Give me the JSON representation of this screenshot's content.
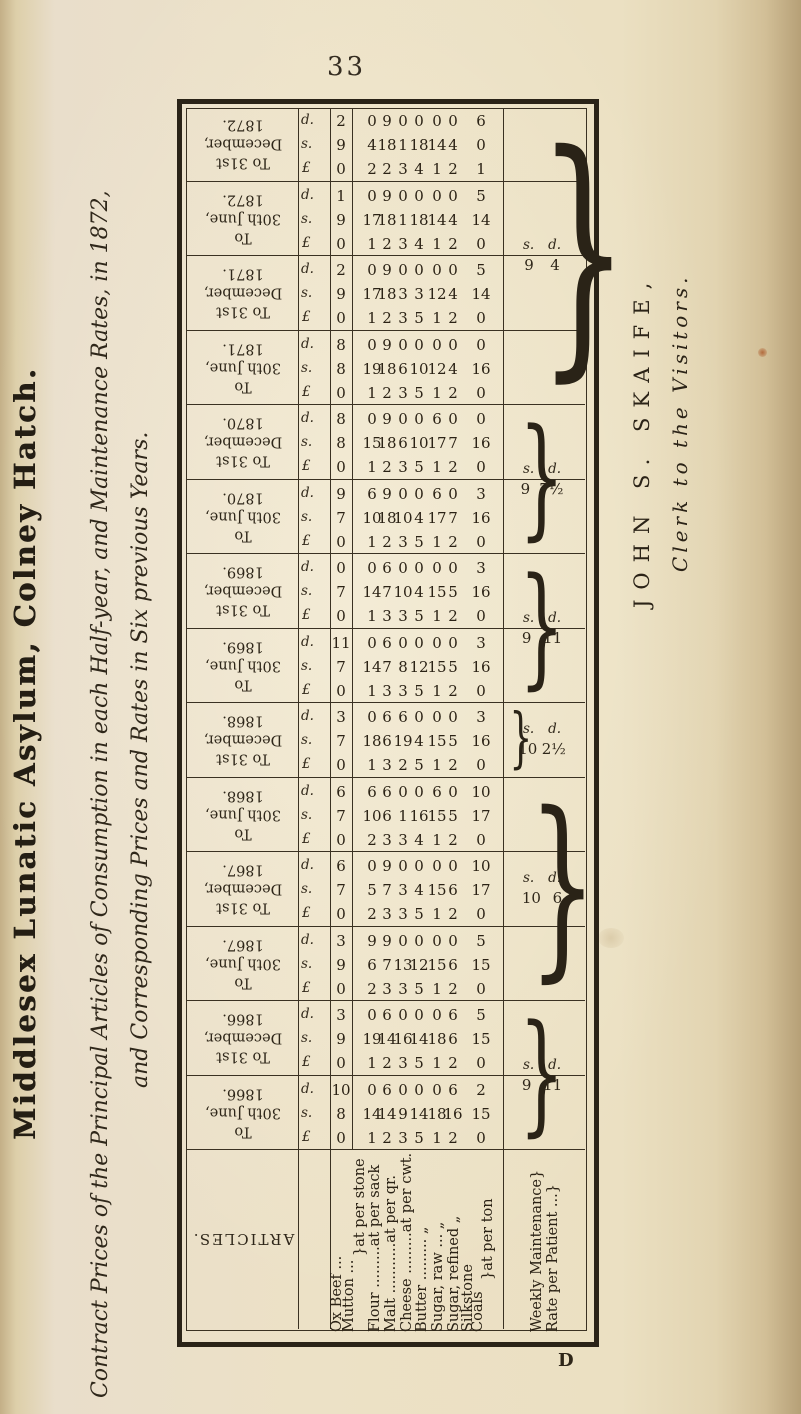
{
  "page": {
    "number": "33"
  },
  "side_heading": {
    "text": "Middlesex Lunatic Asylum, Colney Hatch."
  },
  "title": {
    "line1": "Contract Prices of the Principal Articles of Consumption in each Half-year, and Maintenance Rates, in 1872,",
    "line2": "and Corresponding Prices and Rates in Six previous Years."
  },
  "signature": {
    "name": "JOHN S. SKAIFE,",
    "role": "Clerk to the Visitors."
  },
  "printers_mark": "D",
  "table": {
    "articles_header": "ARTICLES.",
    "money_labels": {
      "pounds": "£",
      "shillings": "s.",
      "pence": "d."
    },
    "article_lines": [
      "Ox Beef ...",
      "Mutton ...",
      "}at per stone",
      "Flour .........at per sack",
      "Malt ...........at per qr.",
      "Cheese .........at per cwt.",
      "Butter .........      „",
      "Sugar, raw ...      „",
      "Sugar, refined      „",
      "Silkstone",
      "Coals",
      "}at per ton",
      "Weekly Maintenance}",
      "Rate per Patient ...}"
    ],
    "columns": [
      {
        "header": [
          "To 31st",
          "December,",
          "1872."
        ],
        "values": [
          [
            0,
            9,
            2
          ],
          [
            2,
            4,
            0
          ],
          [
            2,
            18,
            9
          ],
          [
            3,
            1,
            0
          ],
          [
            4,
            18,
            0
          ],
          [
            1,
            14,
            0
          ],
          [
            2,
            4,
            0
          ],
          [
            1,
            0,
            6
          ]
        ]
      },
      {
        "header": [
          "To",
          "30th June,",
          "1872."
        ],
        "values": [
          [
            0,
            9,
            1
          ],
          [
            1,
            17,
            0
          ],
          [
            2,
            18,
            9
          ],
          [
            3,
            1,
            0
          ],
          [
            4,
            18,
            0
          ],
          [
            1,
            14,
            0
          ],
          [
            2,
            4,
            0
          ],
          [
            0,
            14,
            5
          ]
        ]
      },
      {
        "header": [
          "To 31st",
          "December,",
          "1871."
        ],
        "values": [
          [
            0,
            9,
            2
          ],
          [
            1,
            17,
            0
          ],
          [
            2,
            18,
            9
          ],
          [
            3,
            3,
            0
          ],
          [
            5,
            3,
            0
          ],
          [
            1,
            12,
            0
          ],
          [
            2,
            4,
            0
          ],
          [
            0,
            14,
            5
          ]
        ]
      },
      {
        "header": [
          "To",
          "30th June,",
          "1871."
        ],
        "values": [
          [
            0,
            8,
            8
          ],
          [
            1,
            19,
            0
          ],
          [
            2,
            18,
            9
          ],
          [
            3,
            6,
            0
          ],
          [
            5,
            10,
            0
          ],
          [
            1,
            12,
            0
          ],
          [
            2,
            4,
            0
          ],
          [
            0,
            16,
            0
          ]
        ]
      },
      {
        "header": [
          "To 31st",
          "December,",
          "1870."
        ],
        "values": [
          [
            0,
            8,
            8
          ],
          [
            1,
            15,
            0
          ],
          [
            2,
            18,
            9
          ],
          [
            3,
            6,
            0
          ],
          [
            5,
            10,
            0
          ],
          [
            1,
            17,
            6
          ],
          [
            2,
            7,
            0
          ],
          [
            0,
            16,
            0
          ]
        ]
      },
      {
        "header": [
          "To",
          "30th June,",
          "1870."
        ],
        "values": [
          [
            0,
            7,
            9
          ],
          [
            1,
            10,
            6
          ],
          [
            2,
            18,
            9
          ],
          [
            3,
            10,
            0
          ],
          [
            5,
            4,
            0
          ],
          [
            1,
            17,
            6
          ],
          [
            2,
            7,
            0
          ],
          [
            0,
            16,
            3
          ]
        ]
      },
      {
        "header": [
          "To 31st",
          "December,",
          "1869."
        ],
        "values": [
          [
            0,
            7,
            0
          ],
          [
            1,
            14,
            0
          ],
          [
            3,
            7,
            6
          ],
          [
            3,
            10,
            0
          ],
          [
            5,
            4,
            0
          ],
          [
            1,
            15,
            0
          ],
          [
            2,
            5,
            0
          ],
          [
            0,
            16,
            3
          ]
        ]
      },
      {
        "header": [
          "To",
          "30th June,",
          "1869."
        ],
        "values": [
          [
            0,
            7,
            11
          ],
          [
            1,
            14,
            0
          ],
          [
            3,
            7,
            6
          ],
          [
            3,
            8,
            0
          ],
          [
            5,
            12,
            0
          ],
          [
            1,
            15,
            0
          ],
          [
            2,
            5,
            0
          ],
          [
            0,
            16,
            3
          ]
        ]
      },
      {
        "header": [
          "To 31st",
          "December,",
          "1868."
        ],
        "values": [
          [
            0,
            7,
            3
          ],
          [
            1,
            18,
            0
          ],
          [
            3,
            6,
            6
          ],
          [
            2,
            19,
            6
          ],
          [
            5,
            4,
            0
          ],
          [
            1,
            15,
            0
          ],
          [
            2,
            5,
            0
          ],
          [
            0,
            16,
            3
          ]
        ]
      },
      {
        "header": [
          "To",
          "30th June,",
          "1868."
        ],
        "values": [
          [
            0,
            7,
            6
          ],
          [
            2,
            10,
            6
          ],
          [
            3,
            6,
            6
          ],
          [
            3,
            1,
            0
          ],
          [
            4,
            16,
            0
          ],
          [
            1,
            15,
            6
          ],
          [
            2,
            5,
            0
          ],
          [
            0,
            17,
            10
          ]
        ]
      },
      {
        "header": [
          "To 31st",
          "December,",
          "1867."
        ],
        "values": [
          [
            0,
            7,
            6
          ],
          [
            2,
            5,
            0
          ],
          [
            3,
            7,
            9
          ],
          [
            3,
            3,
            0
          ],
          [
            5,
            4,
            0
          ],
          [
            1,
            15,
            0
          ],
          [
            2,
            6,
            0
          ],
          [
            0,
            17,
            10
          ]
        ]
      },
      {
        "header": [
          "To",
          "30th June,",
          "1867."
        ],
        "values": [
          [
            0,
            9,
            3
          ],
          [
            2,
            6,
            9
          ],
          [
            3,
            7,
            9
          ],
          [
            3,
            13,
            0
          ],
          [
            5,
            12,
            0
          ],
          [
            1,
            15,
            0
          ],
          [
            2,
            6,
            0
          ],
          [
            0,
            15,
            5
          ]
        ]
      },
      {
        "header": [
          "To 31st",
          "December,",
          "1866."
        ],
        "values": [
          [
            0,
            9,
            3
          ],
          [
            1,
            19,
            0
          ],
          [
            2,
            14,
            6
          ],
          [
            3,
            16,
            0
          ],
          [
            5,
            14,
            0
          ],
          [
            1,
            18,
            0
          ],
          [
            2,
            6,
            6
          ],
          [
            0,
            15,
            5
          ]
        ]
      },
      {
        "header": [
          "To",
          "30th June,",
          "1866."
        ],
        "values": [
          [
            0,
            8,
            10
          ],
          [
            1,
            14,
            0
          ],
          [
            2,
            14,
            6
          ],
          [
            3,
            9,
            0
          ],
          [
            5,
            14,
            0
          ],
          [
            1,
            18,
            0
          ],
          [
            2,
            16,
            6
          ],
          [
            0,
            15,
            2
          ]
        ]
      }
    ],
    "maintenance_rates": {
      "label_s": "s.",
      "label_d": "d.",
      "groups": [
        {
          "span": 4,
          "s": "9",
          "d": "4"
        },
        {
          "span": 2,
          "s": "9",
          "d": "7½"
        },
        {
          "span": 2,
          "s": "9",
          "d": "11"
        },
        {
          "span": 1,
          "s": "10",
          "d": "2½"
        },
        {
          "span": 3,
          "s": "10",
          "d": "6"
        },
        {
          "span": 2,
          "s": "9",
          "d": "11"
        }
      ]
    }
  }
}
